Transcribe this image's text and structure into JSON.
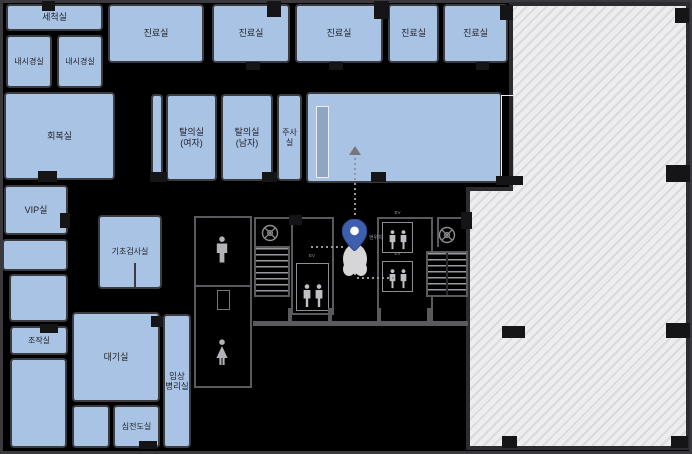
{
  "map": {
    "type": "hospital-floor-plan",
    "colors": {
      "background": "#000000",
      "room_fill": "#a9c3e5",
      "room_border": "#3b3b40",
      "hatch_fill": "#ededef",
      "pin_blue": "#3e5fae"
    },
    "rooms": [
      {
        "label": "세척실"
      },
      {
        "label": "내시경실"
      },
      {
        "label": "내시경실"
      },
      {
        "label": "진료실"
      },
      {
        "label": "진료실"
      },
      {
        "label": "진료실"
      },
      {
        "label": "진료실"
      },
      {
        "label": "진료실"
      },
      {
        "label": "회복실"
      },
      {
        "label": "탈의실 (여자)"
      },
      {
        "label": "탈의실 (남자)"
      },
      {
        "label": "주사실"
      },
      {
        "label": "VIP실"
      },
      {
        "label": "기초검사실"
      },
      {
        "label": "조작실"
      },
      {
        "label": "대기실"
      },
      {
        "label": "심전도실"
      },
      {
        "label": "임상 병리실"
      }
    ],
    "facilities": {
      "pin_label": "현위치",
      "elevator_labels": [
        "EV",
        "EV",
        "EV"
      ]
    }
  }
}
